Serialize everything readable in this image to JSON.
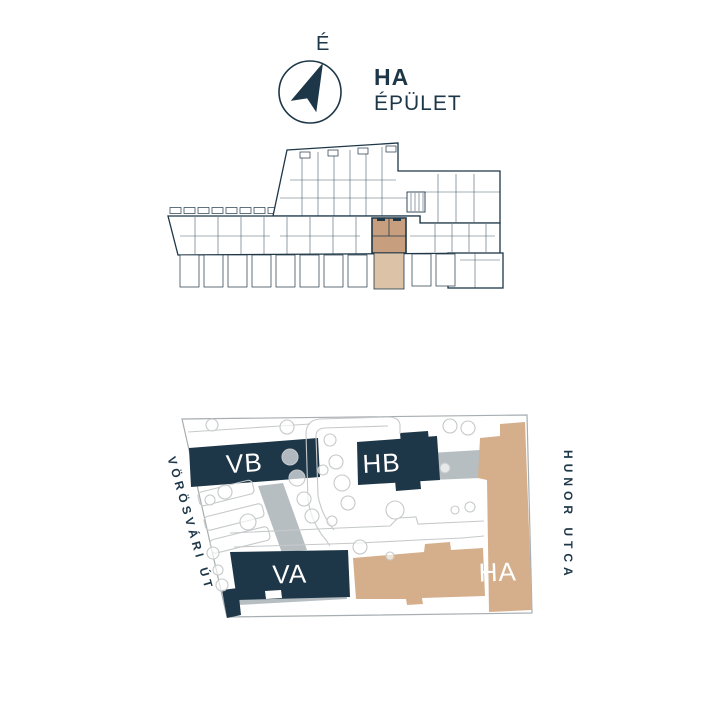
{
  "colors": {
    "navy": "#1e3748",
    "beige": "#d5af8b",
    "beige_dark": "#c79f7e",
    "beige_light": "#dcc3a7",
    "gray": "#b7bec2",
    "path_gray": "#c6c9ca",
    "outline_gray": "#a7adb0"
  },
  "header": {
    "north_label": "É",
    "building_code": "HA",
    "building_word": "ÉPÜLET"
  },
  "site_plan": {
    "buildings": [
      {
        "label": "VB",
        "type": "navy"
      },
      {
        "label": "HB",
        "type": "navy"
      },
      {
        "label": "VA",
        "type": "navy"
      },
      {
        "label": "HA",
        "type": "beige"
      }
    ],
    "streets": [
      {
        "name": "VÖRÖSVÁRI ÚT",
        "side": "left"
      },
      {
        "name": "HUNOR UTCA",
        "side": "right"
      }
    ]
  }
}
